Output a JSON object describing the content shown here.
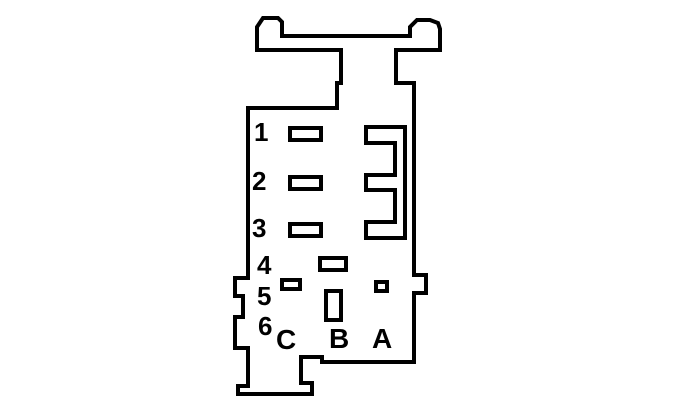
{
  "diagram": {
    "kind": "connector-pinout-line-drawing",
    "background_color": "#ffffff",
    "line_color": "#000000",
    "row_labels": [
      "1",
      "2",
      "3",
      "4",
      "5",
      "6"
    ],
    "column_labels": [
      "C",
      "B",
      "A"
    ]
  }
}
